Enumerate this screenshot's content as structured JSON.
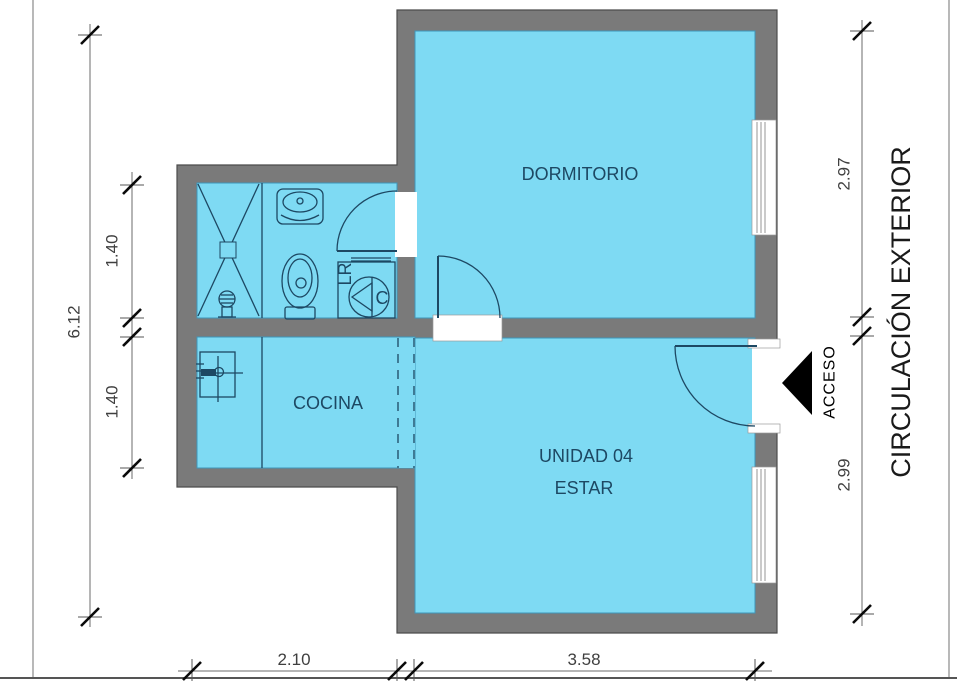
{
  "plan": {
    "rooms": {
      "bedroom": "DORMITORIO",
      "kitchen": "COCINA",
      "unit": "UNIDAD 04",
      "living": "ESTAR"
    },
    "annotations": {
      "access": "ACCESO",
      "exterior_circulation": "CIRCULACIÓN EXTERIOR",
      "washer_label": "LR",
      "heater_label": "C"
    },
    "dimensions": {
      "total_height_left": "6.12",
      "bathroom_depth": "1.40",
      "kitchen_depth": "1.40",
      "bedroom_height_right": "2.97",
      "living_height_right": "2.99",
      "kitchen_width_bottom": "2.10",
      "living_width_bottom": "3.58"
    },
    "colors": {
      "floor": "#7edaf3",
      "wall": "#7a7a7a",
      "drawing_line": "#1d4863",
      "dimension_text": "#3f3f3f",
      "arrow": "#000000",
      "background": "#ffffff"
    }
  }
}
